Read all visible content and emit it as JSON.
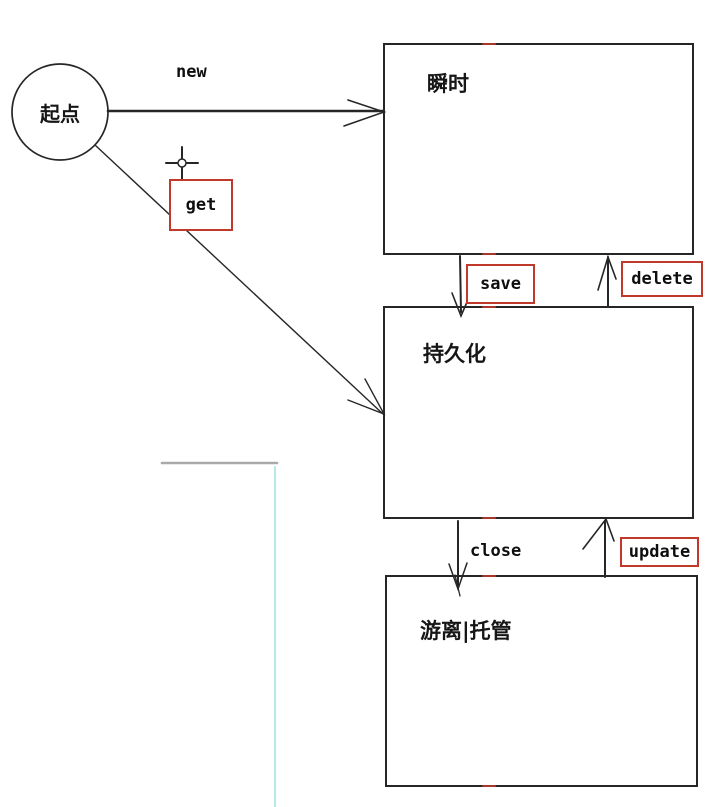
{
  "diagram": {
    "start": {
      "label": "起点"
    },
    "states": [
      {
        "id": "transient",
        "label": "瞬时"
      },
      {
        "id": "persistent",
        "label": "持久化"
      },
      {
        "id": "detached",
        "label": "游离|托管"
      }
    ],
    "transitions": {
      "new": {
        "label": "new",
        "boxed": false,
        "from": "起点",
        "to": "瞬时"
      },
      "get": {
        "label": "get",
        "boxed": true,
        "from": "起点",
        "to": "持久化"
      },
      "save": {
        "label": "save",
        "boxed": true,
        "from": "瞬时",
        "to": "持久化"
      },
      "delete": {
        "label": "delete",
        "boxed": true,
        "from": "持久化",
        "to": "瞬时"
      },
      "close": {
        "label": "close",
        "boxed": false,
        "from": "持久化",
        "to": "游离|托管"
      },
      "update": {
        "label": "update",
        "boxed": true,
        "from": "游离|托管",
        "to": "持久化"
      }
    },
    "colors": {
      "stroke": "#262626",
      "label_box_border": "#c0392b",
      "guide_gray": "#a9a9a9",
      "guide_cyan": "#b6e7e9",
      "background": "#ffffff"
    }
  }
}
